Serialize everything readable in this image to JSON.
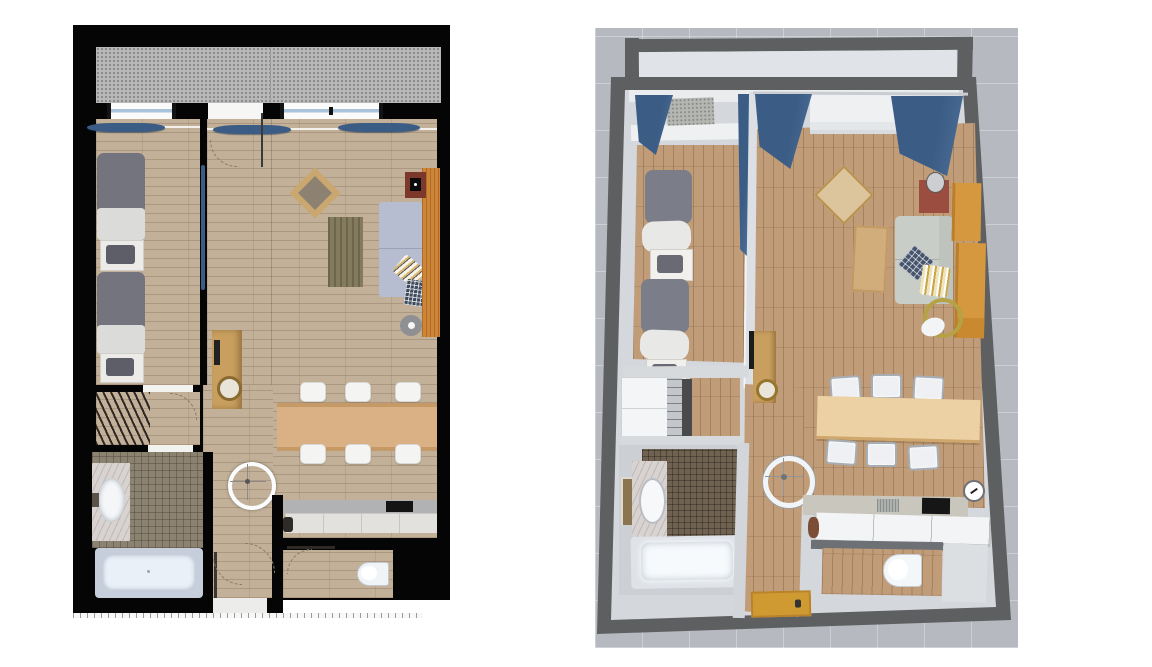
{
  "page": {
    "title": "Apartment floor plan — 2D plan (left) and 3D overhead view (right)",
    "background": "#ffffff"
  },
  "palette": {
    "wall_black": "#050505",
    "balcony_concrete": "#b8b8b8",
    "floor_wood_2d": "#c2b098",
    "plank_line": "#7a6248",
    "window_glass": "#a9c3da",
    "curtain_blue": "#3b5c84",
    "bed_duvet": "#73747e",
    "bed_linen": "#dbdbd9",
    "pillow_dark": "#5e5e68",
    "tile_bath": "#8b8271",
    "marble": "#d8d3d0",
    "tub_rim": "#c6cedb",
    "tub_fill": "#eaf0f7",
    "console_wood": "#c89f5f",
    "dining_table_wood": "#d9b184",
    "chair_white": "#f4f4f2",
    "rug_olive": "#847b5e",
    "sofa_blue_gray": "#b6bdd0",
    "media_panel_orange": "#cd8638",
    "fireplace_red": "#7c392b",
    "counter_gray": "#b0b2b4",
    "cabinet_light": "#e2e1dd",
    "cooktop_black": "#141414",
    "toilet_white": "#f1f4f7",
    "bg_3d": "#b6bac0",
    "wall_dark_3d": "#5e5f60",
    "wall_light_3d": "#d4d7db",
    "wall_top_3d": "#eaecee",
    "floor_wood_3d": "#c09c78",
    "sofa_3d": "#c9cdc7",
    "shelf_orange": "#d6983e",
    "dining_table_3d": "#ecd1a5",
    "tile_3d": "#6f6250",
    "entry_mat_orange": "#d09a33",
    "gold_lamp": "#b5a245"
  },
  "panels": {
    "plan_2d": {
      "label": "2D floor plan (top-down)",
      "rooms": [
        "balcony",
        "bedroom",
        "living room",
        "dining area",
        "kitchen",
        "hallway",
        "walk-in wardrobe",
        "bathroom",
        "WC",
        "entry"
      ],
      "furniture": [
        "single bed x2",
        "nightstand with cushion x2",
        "blue sliding door",
        "clothes rack",
        "washbasin vanity",
        "bathtub",
        "console table with round mirror",
        "ceiling spotlight",
        "dining table",
        "dining chair x6",
        "kitchen counter with cooktop",
        "kettle",
        "toilet",
        "sofa with striped and checked cushions",
        "area rug",
        "rotated square side table",
        "fireplace",
        "wood media panel",
        "round floor lamp",
        "blue curtains",
        "windows and balcony door",
        "dashed door swing arcs",
        "scale tick strip"
      ]
    },
    "plan_3d": {
      "label": "3D overhead view",
      "rooms": [
        "balcony",
        "bedroom",
        "living room",
        "dining area",
        "kitchen",
        "hallway",
        "walk-in wardrobe",
        "bathroom",
        "WC",
        "entry"
      ],
      "furniture": [
        "single bed x2",
        "nightstand with cushion x2",
        "blue curtains",
        "diamond side table",
        "coffee table",
        "sofa with navy check and gold stripe pillows",
        "fireplace with table lamp",
        "wooden shelf unit",
        "gold arc floor lamp",
        "console table with mirror knob",
        "white closets",
        "marble vanity with sink",
        "wall mirror",
        "bathtub",
        "ceiling spotlight",
        "dining table",
        "dining chair x6",
        "kitchen counter with sink and cooktop",
        "white base cabinets",
        "wall clock",
        "toilet",
        "entry door mat"
      ]
    }
  }
}
